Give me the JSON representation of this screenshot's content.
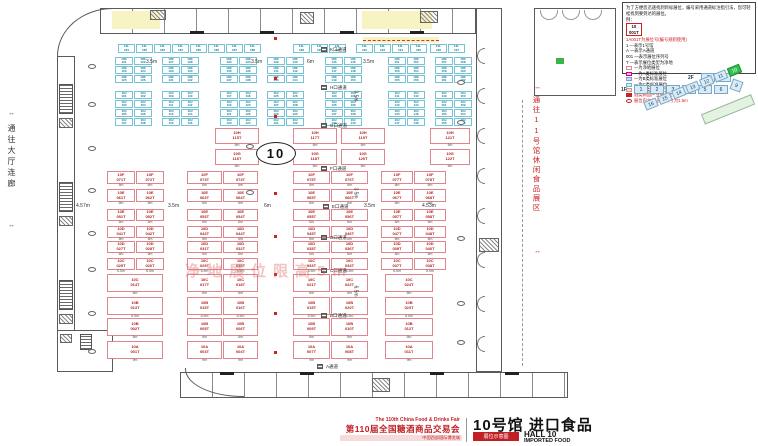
{
  "corridors": {
    "left": "通往大厅连廊",
    "right": "通往11号馆休闲食品展区",
    "arrow": "↔"
  },
  "hall_big_label": "10",
  "watermark": "净地展位限高5m",
  "legend": {
    "intro": "为了方便您迅速找到目标展位，编号采用通道标注指引法，您可轻松找到要到达的展位。",
    "example_label": "例：",
    "example": {
      "line1": "10",
      "line2": "001T"
    },
    "rule_title": "1A001T为展位号(编号规则使用)",
    "rules": [
      "1 —表示1号馆",
      "A —表示A通道",
      "001 —表示展位序列号",
      "T —表示展位类型为净地"
    ],
    "swatches": [
      {
        "type": "outline-pink",
        "label": "—为净地展位",
        "red": false
      },
      {
        "type": "fill-pink",
        "label": "—为A类标准展位",
        "red": false
      },
      {
        "type": "fill-lav",
        "label": "—为B类标准展位",
        "red": false
      },
      {
        "type": "fill-cyan",
        "label": "—为C类标准展位",
        "red": false
      },
      {
        "type": "fill-peach",
        "label": "—为D类标准展位",
        "red": false
      },
      {
        "type": "fill-red",
        "label": "酒类精品产业链专区",
        "red": true
      },
      {
        "type": "ellipse",
        "label": "展位内立柱 直径尺寸为1.5m",
        "red": true
      }
    ]
  },
  "mini_map": {
    "row_2f": {
      "label": "2F",
      "cells": [
        "7",
        "8"
      ]
    },
    "row_1f": {
      "label": "1F",
      "cells": [
        "1",
        "2",
        "3",
        "4",
        "5",
        "6"
      ]
    },
    "diamond": "9",
    "wing_cells": [
      "16",
      "15",
      "14",
      "13",
      "12",
      "11"
    ],
    "wing_highlight": "10"
  },
  "footer": {
    "fair_line_en": "The 110th China Food & Drinks Fair",
    "fair_line_cn": "第110届全国糖酒商品交易会",
    "venue_line": "中国西部国际博览城",
    "tag": "展位示意图",
    "hall_title": "10号馆 进口食品",
    "hall_sub1": "HALL 10",
    "hall_sub2": "IMPORTED FOOD"
  },
  "floor": {
    "cyan_bands": [
      {
        "y": 44,
        "rows": 1,
        "cellW": 17,
        "cellH": 9,
        "prefix": "10L",
        "clusters": [
          {
            "x": 118,
            "cols": 8,
            "start": 181
          },
          {
            "x": 293,
            "cols": 3,
            "start": 189
          },
          {
            "x": 356,
            "cols": 4,
            "start": 192
          },
          {
            "x": 430,
            "cols": 2,
            "start": 196
          }
        ]
      },
      {
        "y": 57,
        "rows": 3,
        "cellW": 18,
        "cellH": 8,
        "prefix": "10K",
        "clusters": [
          {
            "x": 115,
            "cols": 2,
            "start": 121
          },
          {
            "x": 162,
            "cols": 2,
            "start": 127
          },
          {
            "x": 220,
            "cols": 2,
            "start": 133
          },
          {
            "x": 267,
            "cols": 2,
            "start": 139
          },
          {
            "x": 325,
            "cols": 2,
            "start": 145
          },
          {
            "x": 388,
            "cols": 2,
            "start": 151
          },
          {
            "x": 435,
            "cols": 2,
            "start": 157
          }
        ]
      },
      {
        "y": 91,
        "rows": 4,
        "cellW": 18,
        "cellH": 8,
        "prefix": "10J",
        "clusters": [
          {
            "x": 115,
            "cols": 2,
            "start": 101
          },
          {
            "x": 162,
            "cols": 2,
            "start": 109
          },
          {
            "x": 220,
            "cols": 2,
            "start": 117
          },
          {
            "x": 267,
            "cols": 2,
            "start": 125
          },
          {
            "x": 325,
            "cols": 2,
            "start": 133
          },
          {
            "x": 388,
            "cols": 2,
            "start": 141
          },
          {
            "x": 435,
            "cols": 2,
            "start": 149
          }
        ]
      }
    ],
    "pink_bands": [
      {
        "y": 128,
        "rowH": 16,
        "dims": [
          "6m",
          "6m"
        ],
        "blocks": [
          {
            "x": 215,
            "cols": [
              44
            ],
            "top": [
              "10H|115T"
            ],
            "bot": [
              "10G|116T"
            ]
          },
          {
            "x": 293,
            "cols": [
              44
            ],
            "top": [
              "10H|117T"
            ],
            "bot": [
              "10G|118T"
            ]
          },
          {
            "x": 341,
            "cols": [
              44
            ],
            "top": [
              "10H|119T"
            ],
            "bot": [
              "10G|120T"
            ]
          },
          {
            "x": 430,
            "cols": [
              40
            ],
            "top": [
              "10H|121T"
            ],
            "bot": [
              "10G|122T"
            ]
          }
        ]
      },
      {
        "y": 171,
        "rowH": 13,
        "dims": [
          "6m",
          "6m"
        ],
        "blocks": [
          {
            "x": 107,
            "cols": [
              28,
              28
            ],
            "top": [
              "10F|071T",
              "10F|072T"
            ],
            "bot": [
              "10E|061T",
              "10E|062T"
            ]
          },
          {
            "x": 187,
            "cols": [
              35,
              35
            ],
            "top": [
              "10F|073T",
              "10F|074T"
            ],
            "bot": [
              "10E|063T",
              "10E|064T"
            ]
          },
          {
            "x": 293,
            "cols": [
              37,
              37
            ],
            "top": [
              "10F|075T",
              "10F|076T"
            ],
            "bot": [
              "10E|065T",
              "10E|066T"
            ]
          },
          {
            "x": 381,
            "cols": [
              32,
              32
            ],
            "top": [
              "10F|077T",
              "10F|078T"
            ],
            "bot": [
              "10E|067T",
              "10E|068T"
            ]
          }
        ]
      },
      {
        "y": 209,
        "rowH": 12,
        "dims": [
          "6m",
          "6m"
        ],
        "blocks": [
          {
            "x": 107,
            "cols": [
              28,
              28
            ],
            "top": [
              "10E|051T",
              "10E|052T"
            ],
            "bot": [
              "10D|041T",
              "10D|042T"
            ]
          },
          {
            "x": 187,
            "cols": [
              35,
              35
            ],
            "top": [
              "10E|053T",
              "10E|054T"
            ],
            "bot": [
              "10D|043T",
              "10D|044T"
            ]
          },
          {
            "x": 293,
            "cols": [
              37,
              37
            ],
            "top": [
              "10E|055T",
              "10E|056T"
            ],
            "bot": [
              "10D|045T",
              "10D|046T"
            ]
          },
          {
            "x": 381,
            "cols": [
              32,
              32
            ],
            "top": [
              "10E|057T",
              "10E|058T"
            ],
            "bot": [
              "10D|047T",
              "10D|048T"
            ]
          }
        ]
      },
      {
        "y": 241,
        "rowH": 12,
        "dims": [
          "6m",
          "6.5m"
        ],
        "blocks": [
          {
            "x": 107,
            "cols": [
              28,
              28
            ],
            "top": [
              "10D|027T",
              "10D|028T"
            ],
            "bot": [
              "10C|025T",
              "10C|026T"
            ]
          },
          {
            "x": 187,
            "cols": [
              35,
              35
            ],
            "top": [
              "10D|031T",
              "10D|032T"
            ],
            "bot": [
              "10C|029T",
              "10C|030T"
            ]
          },
          {
            "x": 293,
            "cols": [
              37,
              37
            ],
            "top": [
              "10D|035T",
              "10D|036T"
            ],
            "bot": [
              "10C|033T",
              "10C|034T"
            ]
          },
          {
            "x": 381,
            "cols": [
              32,
              32
            ],
            "top": [
              "10D|039T",
              "10D|040T"
            ],
            "bot": [
              "10C|037T",
              "10C|038T"
            ]
          }
        ]
      },
      {
        "y": 274,
        "rowH": 18,
        "dims": [
          "6m",
          "6.5m"
        ],
        "blocks": [
          {
            "x": 107,
            "cols": [
              56
            ],
            "top": [
              "10C|014T"
            ],
            "bot": [
              "10B|013T"
            ]
          },
          {
            "x": 187,
            "cols": [
              35,
              35
            ],
            "top": [
              "10C|017T",
              "10C|018T"
            ],
            "bot": [
              "10B|015T",
              "10B|016T"
            ]
          },
          {
            "x": 293,
            "cols": [
              37,
              37
            ],
            "top": [
              "10C|021T",
              "10C|022T"
            ],
            "bot": [
              "10B|019T",
              "10B|020T"
            ]
          },
          {
            "x": 385,
            "cols": [
              48
            ],
            "top": [
              "10C|024T"
            ],
            "bot": [
              "10B|023T"
            ]
          }
        ]
      },
      {
        "y": 318,
        "rowH": 18,
        "dims": [
          "6m",
          "9m"
        ],
        "blocks": [
          {
            "x": 107,
            "cols": [
              56
            ],
            "top": [
              "10B|002T"
            ],
            "bot": [
              "10A|001T"
            ]
          },
          {
            "x": 187,
            "cols": [
              35,
              35
            ],
            "top": [
              "10B|005T",
              "10B|006T"
            ],
            "bot": [
              "10A|003T",
              "10A|004T"
            ]
          },
          {
            "x": 293,
            "cols": [
              37,
              37
            ],
            "top": [
              "10B|009T",
              "10B|010T"
            ],
            "bot": [
              "10A|007T",
              "10A|008T"
            ]
          },
          {
            "x": 385,
            "cols": [
              48
            ],
            "top": [
              "10B|012T"
            ],
            "bot": [
              "10A|011T"
            ]
          }
        ]
      }
    ],
    "aisle_labels": [
      {
        "t": "K口通道",
        "x": 330,
        "y": 47
      },
      {
        "t": "H口通道",
        "x": 330,
        "y": 85
      },
      {
        "t": "G口通道",
        "x": 330,
        "y": 123
      },
      {
        "t": "F口通道",
        "x": 330,
        "y": 166
      },
      {
        "t": "E口通道",
        "x": 332,
        "y": 204
      },
      {
        "t": "D口通道",
        "x": 330,
        "y": 235
      },
      {
        "t": "C口通道",
        "x": 330,
        "y": 268
      },
      {
        "t": "B口通道",
        "x": 330,
        "y": 313
      },
      {
        "t": "A通道",
        "x": 326,
        "y": 364
      }
    ],
    "dim_labels": [
      {
        "t": "3.5m",
        "x": 146,
        "y": 59,
        "rot": 0
      },
      {
        "t": "3.5m",
        "x": 251,
        "y": 59,
        "rot": 0
      },
      {
        "t": "6m",
        "x": 307,
        "y": 59,
        "rot": 0
      },
      {
        "t": "3.5m",
        "x": 363,
        "y": 59,
        "rot": 0
      },
      {
        "t": "4.57m",
        "x": 76,
        "y": 203,
        "rot": 0
      },
      {
        "t": "3.5m",
        "x": 168,
        "y": 203,
        "rot": 0
      },
      {
        "t": "6m",
        "x": 264,
        "y": 203,
        "rot": 0
      },
      {
        "t": "3.5m",
        "x": 364,
        "y": 203,
        "rot": 0
      },
      {
        "t": "4.53m",
        "x": 422,
        "y": 203,
        "rot": 0
      },
      {
        "t": "3.5m",
        "x": 350,
        "y": 93,
        "rot": 90
      },
      {
        "t": "3.5m",
        "x": 350,
        "y": 190,
        "rot": 90
      },
      {
        "t": "6.5m",
        "x": 350,
        "y": 288,
        "rot": 90
      }
    ],
    "red_squares": [
      [
        274,
        37
      ],
      [
        274,
        77
      ],
      [
        274,
        115
      ],
      [
        274,
        192
      ],
      [
        274,
        235
      ],
      [
        274,
        273
      ],
      [
        274,
        312
      ],
      [
        274,
        351
      ]
    ],
    "columns": [
      [
        88,
        64
      ],
      [
        88,
        102
      ],
      [
        88,
        146
      ],
      [
        88,
        188
      ],
      [
        88,
        231
      ],
      [
        88,
        267
      ],
      [
        88,
        311
      ],
      [
        88,
        349
      ],
      [
        246,
        144
      ],
      [
        246,
        190
      ],
      [
        457,
        80
      ],
      [
        457,
        120
      ],
      [
        457,
        236
      ],
      [
        457,
        301
      ],
      [
        457,
        340
      ]
    ]
  }
}
